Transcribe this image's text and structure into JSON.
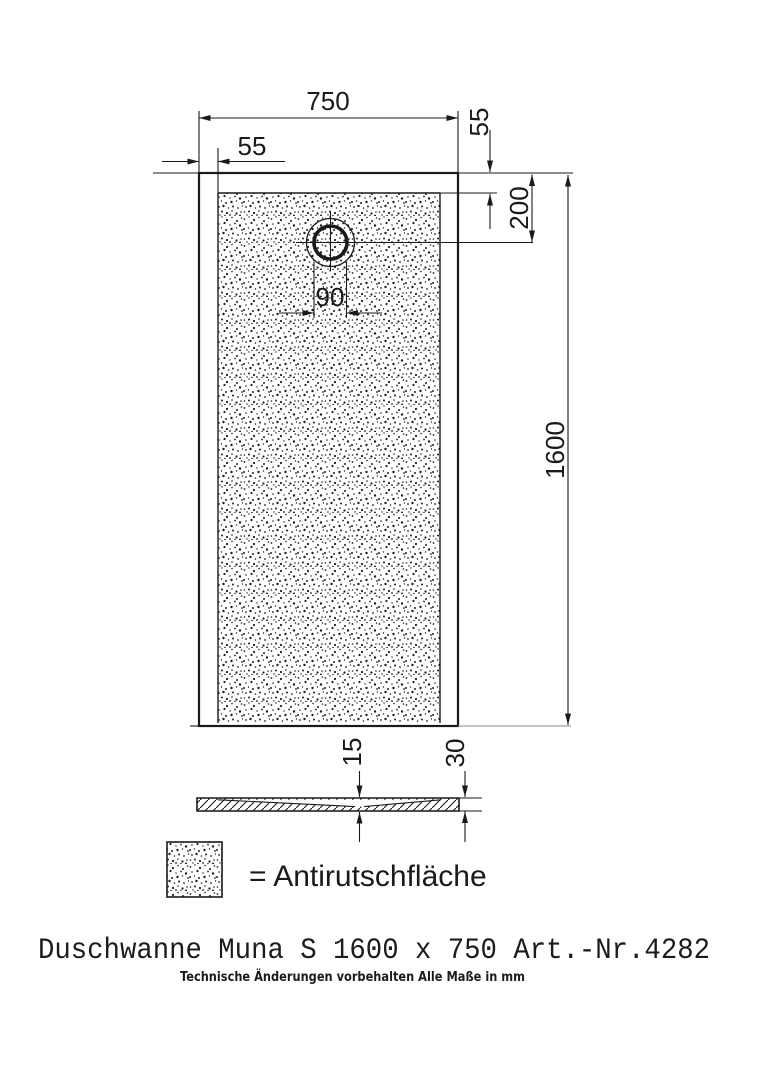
{
  "canvas": {
    "background": "#ffffff",
    "ink": "#1a1a1a"
  },
  "drawing": {
    "dimensions": {
      "overall_width": "750",
      "rim_left": "55",
      "rim_top": "55",
      "drain_offset": "200",
      "drain_diameter": "90",
      "overall_length": "1600",
      "depth_center": "15",
      "edge_height": "30"
    },
    "legend": {
      "label": "= Antirutschfläche"
    },
    "title": "Duschwanne Muna S 1600 x 750 Art.-Nr.4282",
    "footnote": "Technische Änderungen vorbehalten  Alle Maße in mm"
  }
}
